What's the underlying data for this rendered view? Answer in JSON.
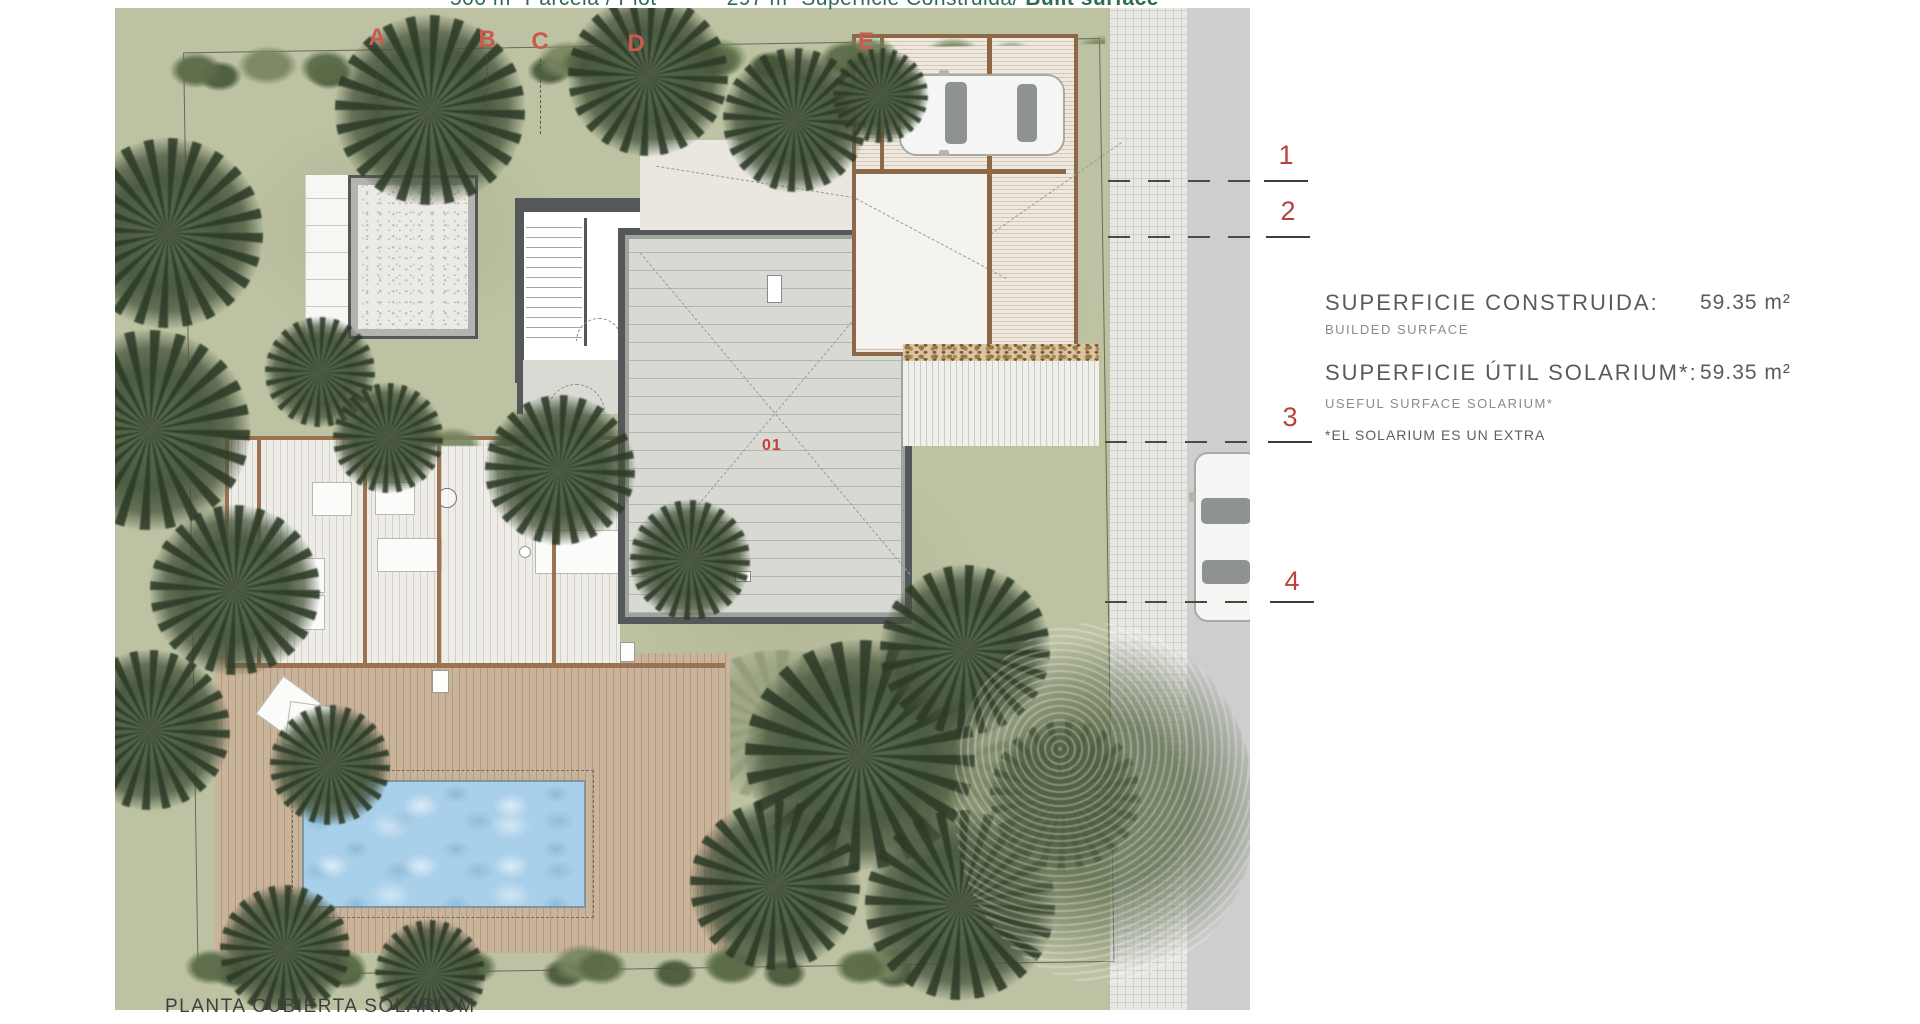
{
  "header": {
    "plot": "500 m² Parcela / Plot",
    "built": "297 m² Superficie Construida/",
    "built_bold": "Built surface"
  },
  "annotations": {
    "grid_letters": [
      "A",
      "B",
      "C",
      "D",
      "E"
    ],
    "grid_numbers": [
      "1",
      "2",
      "3",
      "4"
    ],
    "room_number": "01"
  },
  "info_panel": {
    "rows": [
      {
        "label": "SUPERFICIE CONSTRUIDA:",
        "sublabel": "BUILDED SURFACE",
        "value": "59.35 m²"
      },
      {
        "label": "SUPERFICIE ÚTIL SOLARIUM*:",
        "sublabel": "USEFUL SURFACE SOLARIUM*",
        "value": "59.35 m²"
      }
    ],
    "footnote": "*EL SOLARIUM ES UN EXTRA"
  },
  "caption": "PLANTA CUBIERTA SOLÁRIUM",
  "colors": {
    "accent_red": "#c04a41",
    "header_green": "#2e6b50",
    "text_gray": "#5f5f5f",
    "pool_blue": "#a9d0ea",
    "roof_gray": "#d7d9d2",
    "pergola_brown": "#9b7353"
  }
}
